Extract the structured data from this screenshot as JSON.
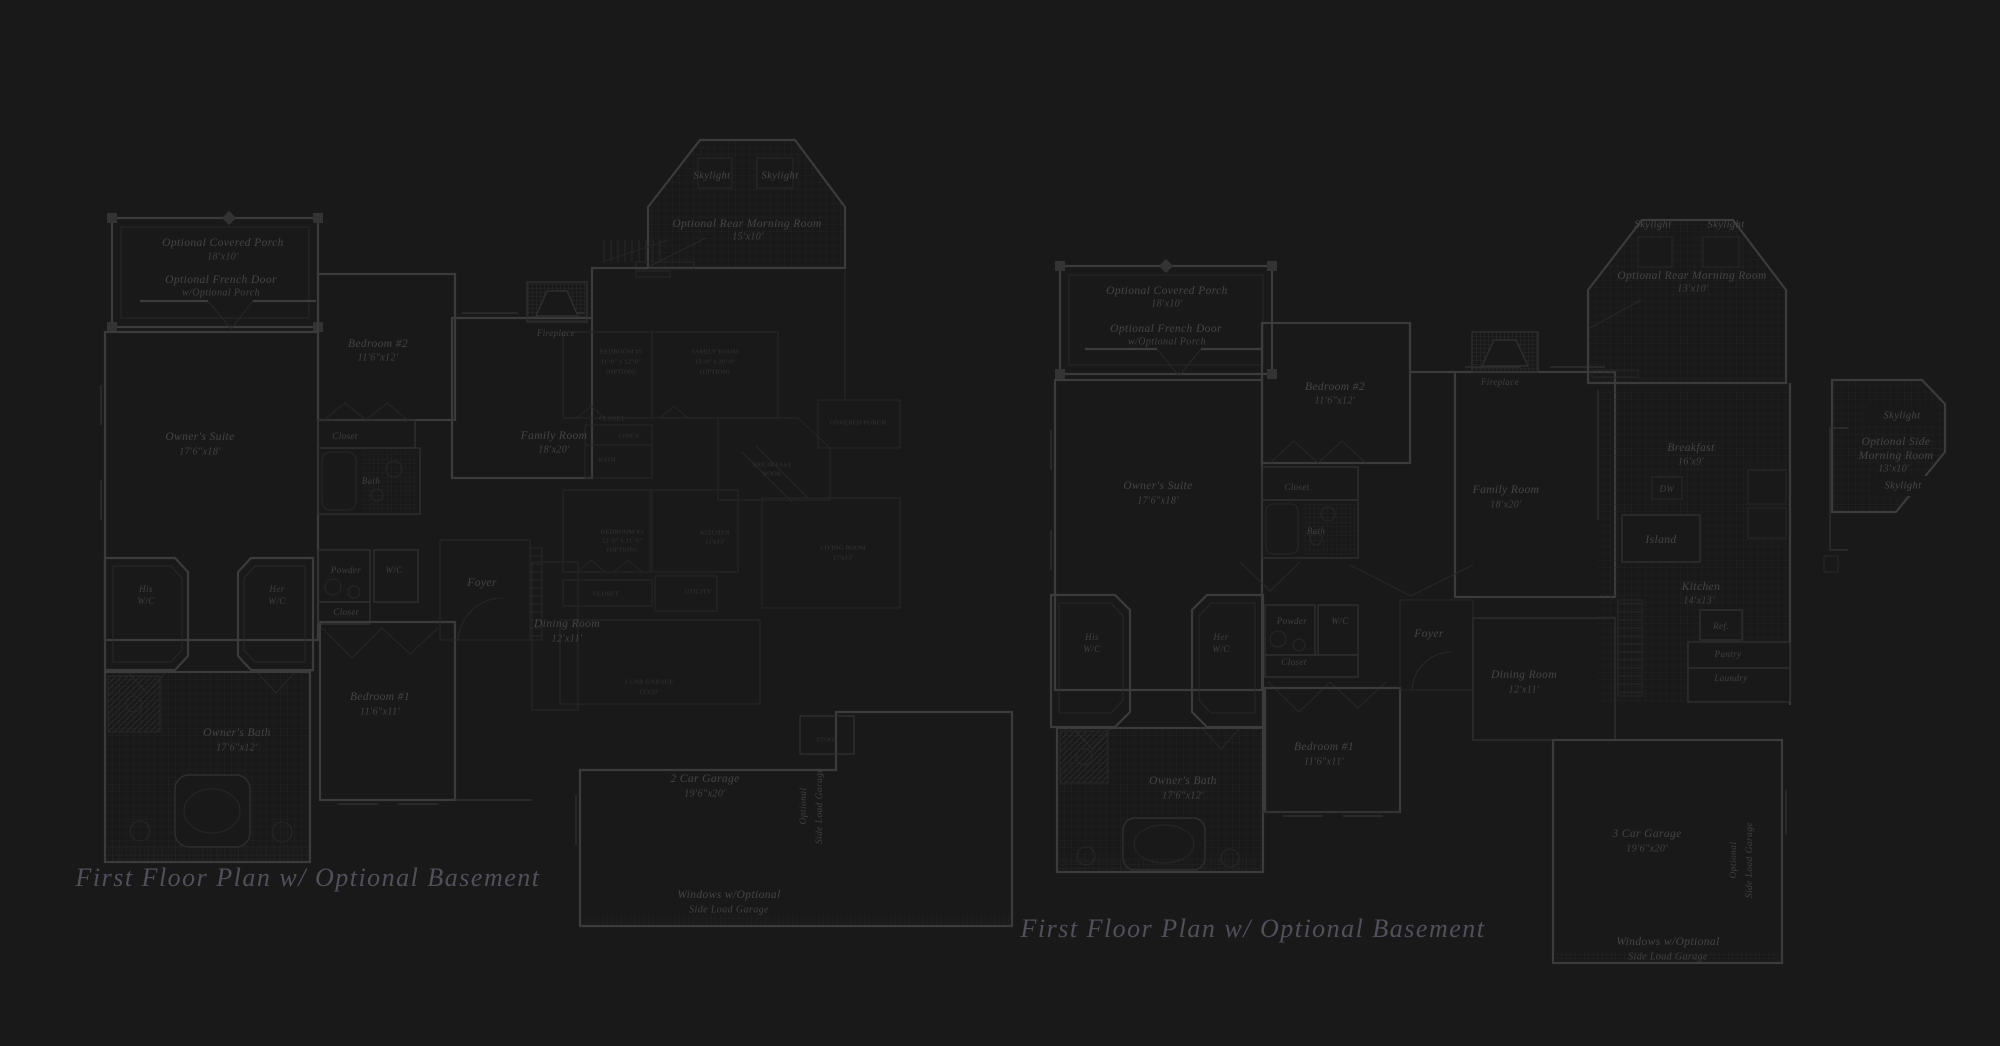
{
  "colors": {
    "background": "#1a191a",
    "wall_line": "#3b3b3b",
    "medium_line": "#2f2f2f",
    "thin_line": "#282828",
    "tile_grid": "#232323",
    "label_text": "#454545",
    "faint_text": "#343434",
    "caption_text": "#50505a"
  },
  "left_plan": {
    "caption": "First Floor Plan  w/ Optional Basement",
    "porch_l1": "Optional Covered Porch",
    "porch_l2": "18'x10'",
    "french_l1": "Optional French Door",
    "french_l2": "w/Optional Porch",
    "owners_suite_l1": "Owner's Suite",
    "owners_suite_l2": "17'6\"x18'",
    "bedroom2_l1": "Bedroom #2",
    "bedroom2_l2": "11'6\"x12'",
    "closet_top": "Closet",
    "bath": "Bath",
    "his_l1": "His",
    "his_l2": "W/C",
    "her_l1": "Her",
    "her_l2": "W/C",
    "powder": "Powder",
    "wc": "W/C",
    "closet_mid": "Closet",
    "owners_bath_l1": "Owner's Bath",
    "owners_bath_l2": "17'6\"x12'",
    "bedroom1_l1": "Bedroom #1",
    "bedroom1_l2": "11'6\"x11'",
    "foyer": "Foyer",
    "dining_l1": "Dining Room",
    "dining_l2": "12'x11'",
    "family_l1": "Family Room",
    "family_l2": "18'x20'",
    "fireplace": "Fireplace",
    "sky1": "Skylight",
    "sky2": "Skylight",
    "morning_l1": "Optional Rear Morning Room",
    "morning_l2": "15'x10'",
    "garage_l1": "2 Car Garage",
    "garage_l2": "19'6\"x20'",
    "sideload_l1": "Optional",
    "sideload_l2": "Side Load Garage",
    "windows_l1": "Windows w/Optional",
    "windows_l2": "Side Load Garage"
  },
  "overlay_plan": {
    "bedroom5_l1": "BEDROOM #5",
    "bedroom5_l2": "11'-0\" x 12'-0\"",
    "bedroom5_l3": "(OPTION)",
    "familyopt_l1": "FAMILY ROOM",
    "familyopt_l2": "15'-0\" x 20'-0\"",
    "familyopt_l3": "(OPTION)",
    "closet_a": "CLOSET",
    "linen": "LINEN",
    "bath": "BATH",
    "bedroom3_l1": "BEDROOM #3",
    "bedroom3_l2": "12'-0\" x 11'-0\"",
    "bedroom3_l3": "(OPTION)",
    "breakfast_l1": "BREAKFAST",
    "breakfast_l2": "NOOK",
    "kitchen_l1": "KITCHEN",
    "kitchen_l2": "11'x13'",
    "utility": "UTILITY",
    "closet_b": "CLOSET",
    "living_l1": "LIVING ROOM",
    "living_l2": "17'x13'",
    "porch": "COVERED PORCH",
    "garage_l1": "1 CAR GARAGE",
    "garage_l2": "12'x20'",
    "stoop": "STOOP"
  },
  "right_plan": {
    "caption": "First Floor Plan  w/ Optional Basement",
    "porch_l1": "Optional Covered Porch",
    "porch_l2": "18'x10'",
    "french_l1": "Optional French Door",
    "french_l2": "w/Optional Porch",
    "owners_suite_l1": "Owner's Suite",
    "owners_suite_l2": "17'6\"x18'",
    "bedroom2_l1": "Bedroom #2",
    "bedroom2_l2": "11'6\"x12'",
    "closet_top": "Closet",
    "bath": "Bath",
    "family_l1": "Family Room",
    "family_l2": "18'x20'",
    "fireplace": "Fireplace",
    "sky1": "Skylight",
    "sky2": "Skylight",
    "morning_l1": "Optional Rear Morning Room",
    "morning_l2": "13'x10'",
    "breakfast_l1": "Breakfast",
    "breakfast_l2": "16'x9'",
    "dw": "DW",
    "island": "Island",
    "kitchen_l1": "Kitchen",
    "kitchen_l2": "14'x13'",
    "ref": "Ref.",
    "pantry": "Pantry",
    "laundry": "Laundry",
    "side_sky1": "Skylight",
    "side_l1": "Optional Side",
    "side_l2": "Morning Room",
    "side_l3": "13'x10'",
    "side_sky2": "Skylight",
    "his_l1": "His",
    "his_l2": "W/C",
    "her_l1": "Her",
    "her_l2": "W/C",
    "powder": "Powder",
    "wc": "W/C",
    "closet_mid": "Closet",
    "owners_bath_l1": "Owner's Bath",
    "owners_bath_l2": "17'6\"x12'",
    "bedroom1_l1": "Bedroom #1",
    "bedroom1_l2": "11'6\"x11'",
    "foyer": "Foyer",
    "dining_l1": "Dining Room",
    "dining_l2": "12'x11'",
    "garage_l1": "3 Car Garage",
    "garage_l2": "19'6\"x20'",
    "sideload_l1": "Optional",
    "sideload_l2": "Side Load Garage",
    "windows_l1": "Windows w/Optional",
    "windows_l2": "Side Load Garage"
  }
}
